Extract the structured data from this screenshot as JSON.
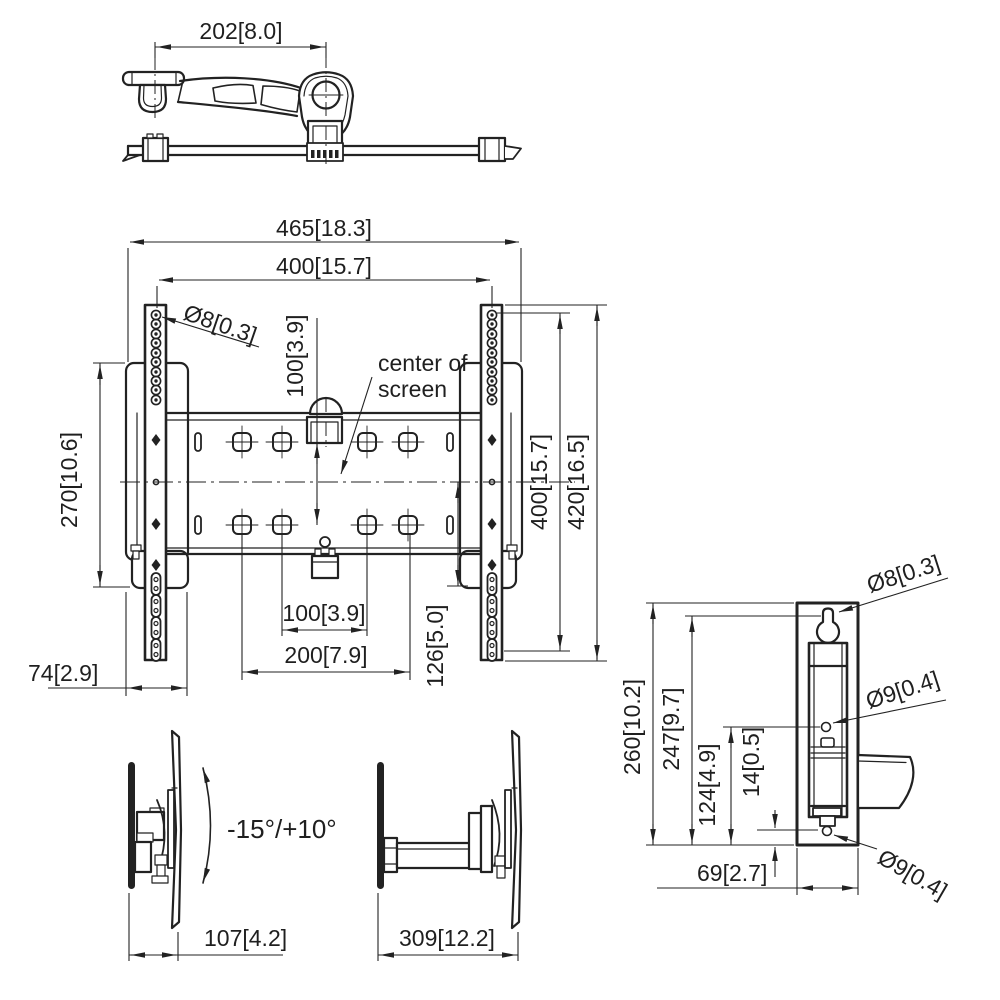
{
  "colors": {
    "background": "#ffffff",
    "line": "#222222",
    "text": "#1f1f1f"
  },
  "views": {
    "top": {
      "dim_arm_depth": "202[8.0]"
    },
    "front": {
      "dim_total_width": "465[18.3]",
      "dim_hole_span_width": "400[15.7]",
      "label_rail_hole_dia": "Ø8[0.3]",
      "dim_vesa_vertical": "100[3.9]",
      "center_label_line1": "center of",
      "center_label_line2": "screen",
      "dim_strip_height": "270[10.6]",
      "dim_strip_width": "74[2.9]",
      "dim_rail_hole_height": "400[15.7]",
      "dim_rail_height": "420[16.5]",
      "dim_vesa_100": "100[3.9]",
      "dim_vesa_200": "200[7.9]",
      "dim_center_to_bottom": "126[5.0]"
    },
    "side_folded": {
      "tilt_range": "-15°/+10°",
      "dim_depth": "107[4.2]"
    },
    "side_extended": {
      "dim_depth": "309[12.2]"
    },
    "side_profile": {
      "label_keyhole_dia": "Ø8[0.3]",
      "label_mid_hole_dia": "Ø9[0.4]",
      "label_bottom_hole_dia": "Ø9[0.4]",
      "dim_plate_height": "260[10.2]",
      "dim_keyhole_to_bottom": "247[9.7]",
      "dim_mid_hole_to_bottom": "124[4.9]",
      "dim_bottom_hole_offset": "14[0.5]",
      "dim_plate_width": "69[2.7]"
    }
  }
}
